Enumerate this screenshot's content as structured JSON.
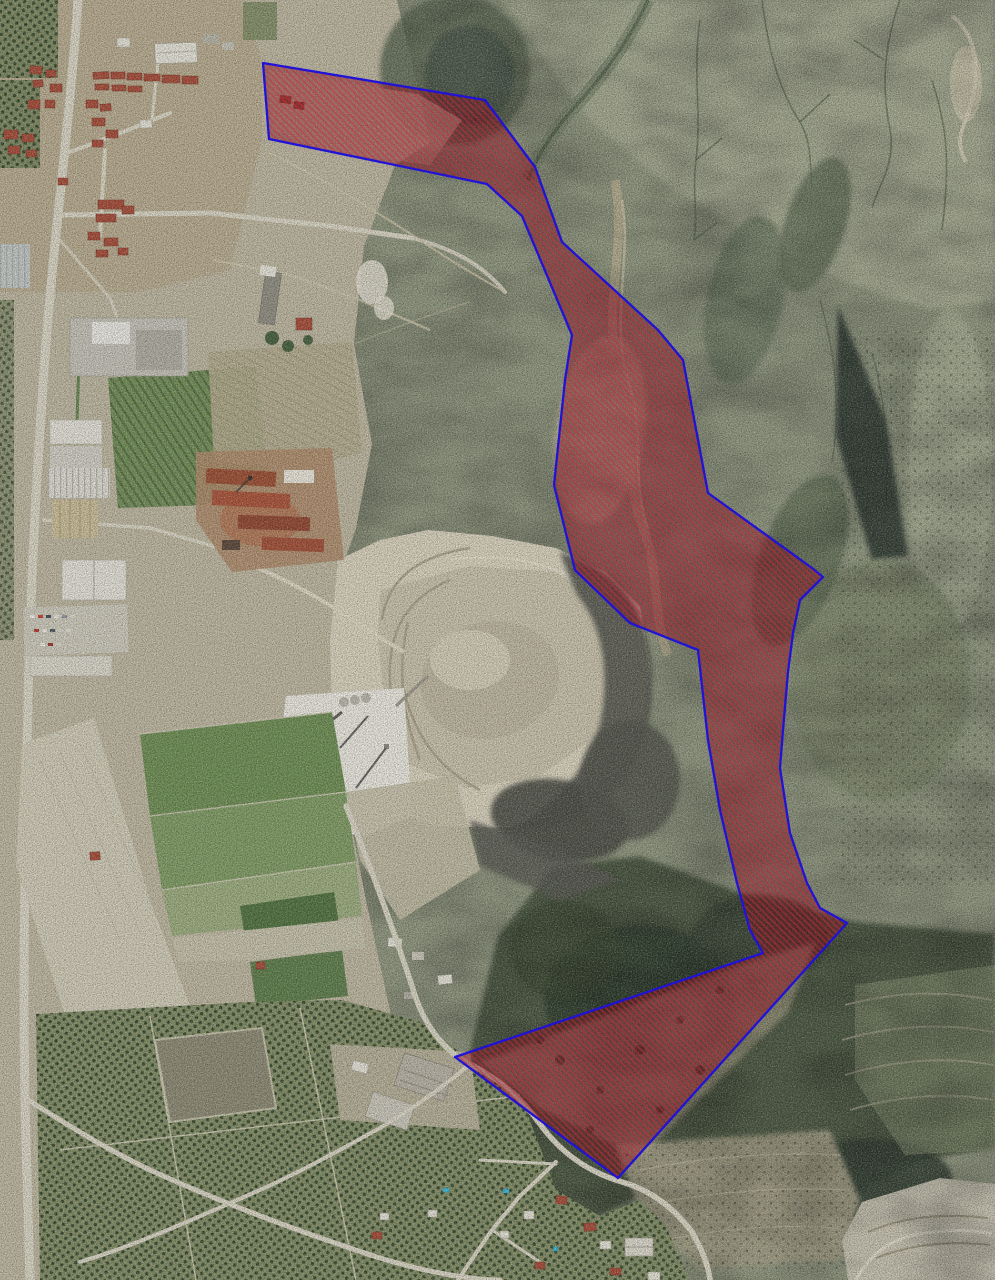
{
  "map": {
    "description": "aerial-orthophoto-with-highlighted-zone",
    "overlay": {
      "label": "highlighted-zone",
      "outline_color": "#2013d6",
      "hatch_style": "fine-diagonal-45",
      "points": "263,63 485,100 535,167 562,242 658,330 683,360 708,493 812,568 823,577 800,600 793,633 788,672 783,730 780,768 790,833 807,883 820,908 847,923 618,1178 455,1057 763,953 750,930 737,883 720,810 708,740 698,650 630,623 575,570 554,485 565,380 572,335 522,216 487,184 269,139"
    },
    "palette": {
      "lowland": "#bcb59e",
      "mountain": "#8d947c",
      "scrub_dark": "#46523e",
      "quarry_light": "#d7d0bb",
      "plant_white": "#e9e7dd",
      "spoil_dark": "#55564d",
      "field_green": "#6d8d52",
      "orchard_base": "#828c64",
      "orchard_dot": "#34492e",
      "road": "#d8d4c3",
      "roof_red": "#a54b37",
      "building_white": "#e4e2d6",
      "pool_blue": "#3fb9d6",
      "zone_base": "rgba(112,10,24,0.40)",
      "zone_hatch": "rgba(206,44,62,0.50)",
      "zone_outline": "#2013d6"
    },
    "features": [
      "town",
      "orchards",
      "industrial-warehouses",
      "brick-factory",
      "vineyards",
      "quarry",
      "processing-plant",
      "green-fields",
      "badlands",
      "drainage-gullies",
      "scrubland",
      "terraced-slope",
      "gravel-pit",
      "village",
      "roads",
      "swimming-pools",
      "highlighted-zone-polygon"
    ]
  }
}
